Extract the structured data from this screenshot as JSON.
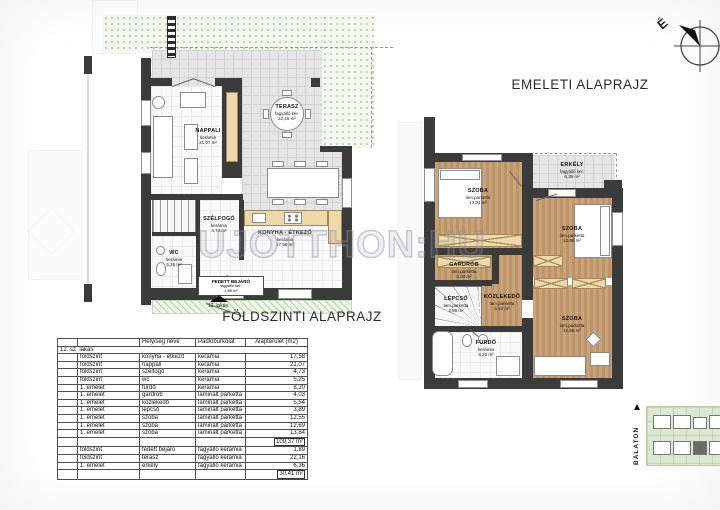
{
  "watermark": {
    "text": "UJOTTHON:HU"
  },
  "compass": {
    "label": "É"
  },
  "site_plan": {
    "label": "BALATON"
  },
  "ground_floor": {
    "title": "FÖLDSZINTI ALAPRAJZ",
    "unit_marker": "12. lakás",
    "rooms": [
      {
        "name": "NAPPALI",
        "material": "kerámia",
        "area": "21,07 m²"
      },
      {
        "name": "TERASZ",
        "material": "fagyálló ker.",
        "area": "22,16 m²"
      },
      {
        "name": "SZÉLFOGÓ",
        "material": "kerámia",
        "area": "4,73 m²"
      },
      {
        "name": "WC",
        "material": "kerámia",
        "area": "5,25 m²"
      },
      {
        "name": "KONYHA - ÉTKEZŐ",
        "material": "kerámia",
        "area": "17,58 m²"
      },
      {
        "name": "FEDETT BEJÁRÓ",
        "material": "fagyálló ker.",
        "area": "1,89 m²"
      }
    ]
  },
  "upper_floor": {
    "title": "EMELETI ALAPRAJZ",
    "rooms": [
      {
        "name": "SZOBA",
        "material": "lam.parketta",
        "area": "13,84 m²"
      },
      {
        "name": "ERKÉLY",
        "material": "fagyálló ker.",
        "area": "6,36 m²"
      },
      {
        "name": "SZOBA",
        "material": "lam.parketta",
        "area": "12,69 m²"
      },
      {
        "name": "GARDRÓB",
        "material": "lam.parketta",
        "area": "4,03 m²"
      },
      {
        "name": "LÉPCSŐ",
        "material": "lam.parketta",
        "area": "3,89 m²"
      },
      {
        "name": "KÖZLEKEDŐ",
        "material": "lam.parketta",
        "area": "5,54 m²"
      },
      {
        "name": "FÜRDŐ",
        "material": "kerámia",
        "area": "8,20 m²"
      },
      {
        "name": "SZOBA",
        "material": "lam.parketta",
        "area": "12,55 m²"
      }
    ]
  },
  "area_table": {
    "unit_label": "12. sz. lakás",
    "headers": {
      "room": "Helyiség neve",
      "material": "Padlóburkolat",
      "area": "Alapterület (m2)"
    },
    "interior_rows": [
      {
        "floor": "földszint",
        "room": "konyha - étkező",
        "material": "kerámia",
        "area": "17,58"
      },
      {
        "floor": "földszint",
        "room": "nappali",
        "material": "kerámia",
        "area": "21,07"
      },
      {
        "floor": "földszint",
        "room": "szélfogó",
        "material": "kerámia",
        "area": "4,73"
      },
      {
        "floor": "földszint",
        "room": "wc",
        "material": "kerámia",
        "area": "5,25"
      },
      {
        "floor": "1. emelet",
        "room": "fürdő",
        "material": "kerámia",
        "area": "8,20"
      },
      {
        "floor": "1. emelet",
        "room": "gardrób",
        "material": "laminált parketta",
        "area": "4,03"
      },
      {
        "floor": "1. emelet",
        "room": "közlekedő",
        "material": "laminált parketta",
        "area": "5,54"
      },
      {
        "floor": "1. emelet",
        "room": "lépcső",
        "material": "laminált parketta",
        "area": "3,89"
      },
      {
        "floor": "1. emelet",
        "room": "szoba",
        "material": "laminált parketta",
        "area": "12,55"
      },
      {
        "floor": "1. emelet",
        "room": "szoba",
        "material": "laminált parketta",
        "area": "12,69"
      },
      {
        "floor": "1. emelet",
        "room": "szoba",
        "material": "laminált parketta",
        "area": "13,84"
      }
    ],
    "interior_total": "109,37 m²",
    "exterior_rows": [
      {
        "floor": "földszint",
        "room": "fedett bejáró",
        "material": "fagyálló kerámia",
        "area": "1,89"
      },
      {
        "floor": "földszint",
        "room": "terasz",
        "material": "fagyálló kerámia",
        "area": "22,16"
      },
      {
        "floor": "1. emelet",
        "room": "erkély",
        "material": "fagyálló kerámia",
        "area": "6,36"
      }
    ],
    "exterior_total": "30,41 m²"
  }
}
